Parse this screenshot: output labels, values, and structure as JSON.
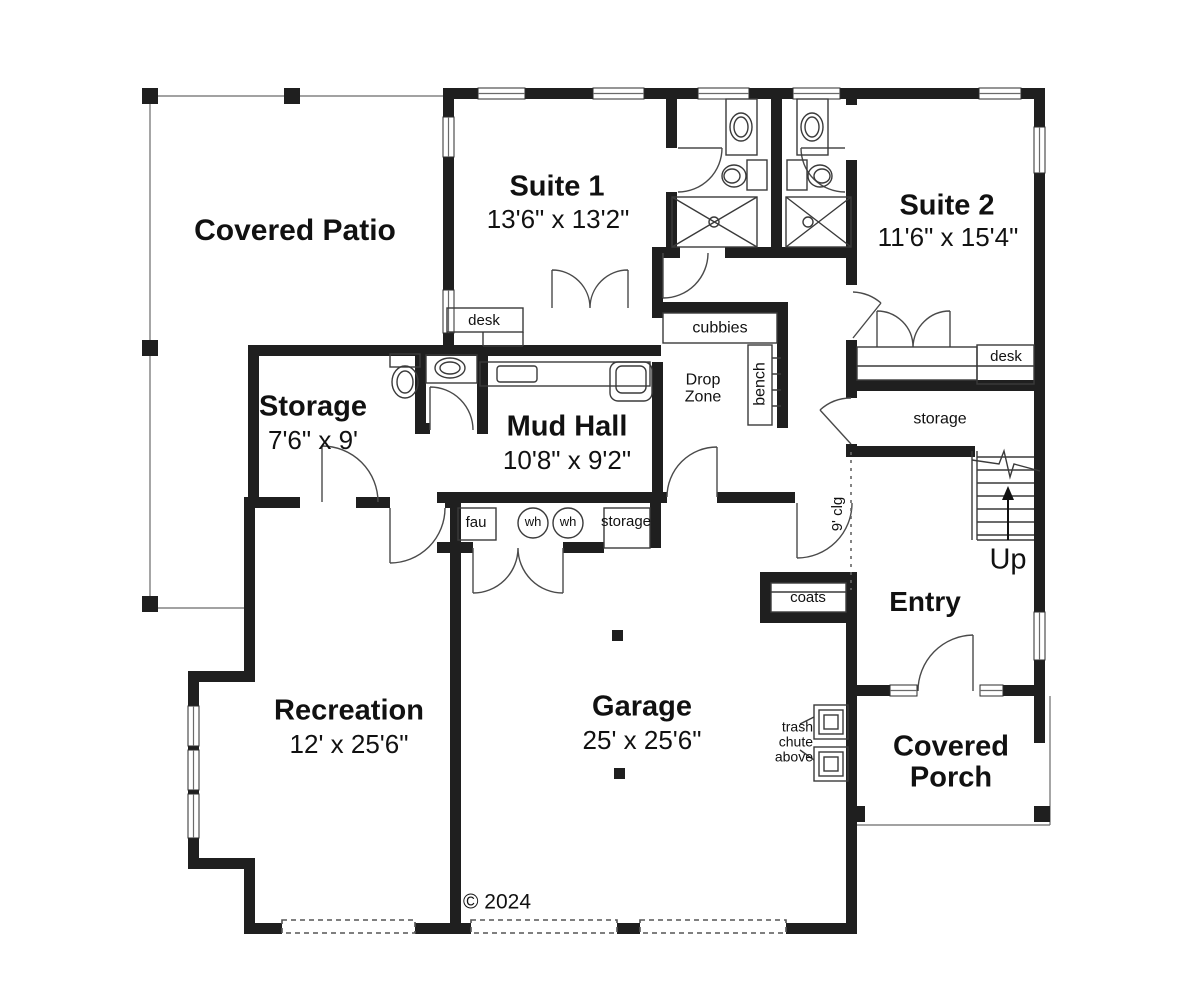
{
  "meta": {
    "copyright": "© 2024"
  },
  "rooms": {
    "covered_patio": {
      "name": "Covered Patio"
    },
    "suite1": {
      "name": "Suite 1",
      "dims": "13'6\" x 13'2\""
    },
    "suite2": {
      "name": "Suite 2",
      "dims": "11'6\" x 15'4\""
    },
    "storage": {
      "name": "Storage",
      "dims": "7'6\" x 9'"
    },
    "mud_hall": {
      "name": "Mud Hall",
      "dims": "10'8\" x 9'2\""
    },
    "recreation": {
      "name": "Recreation",
      "dims": "12' x 25'6\""
    },
    "garage": {
      "name": "Garage",
      "dims": "25' x 25'6\""
    },
    "entry": {
      "name": "Entry"
    },
    "covered_porch": {
      "name": "Covered Porch"
    }
  },
  "labels": {
    "desk_suite1": "desk",
    "desk_suite2": "desk",
    "cubbies": "cubbies",
    "bench": "bench",
    "drop_zone": "Drop Zone",
    "storage_hall": "storage",
    "storage_utility": "storage",
    "coats": "coats",
    "fau": "fau",
    "wh1": "wh",
    "wh2": "wh",
    "nine_clg": "9' clg",
    "up": "Up",
    "trash_chute": "trash chute above"
  },
  "colors": {
    "wall": "#1f1f1f",
    "line": "#3a3a3a",
    "background": "#ffffff"
  }
}
